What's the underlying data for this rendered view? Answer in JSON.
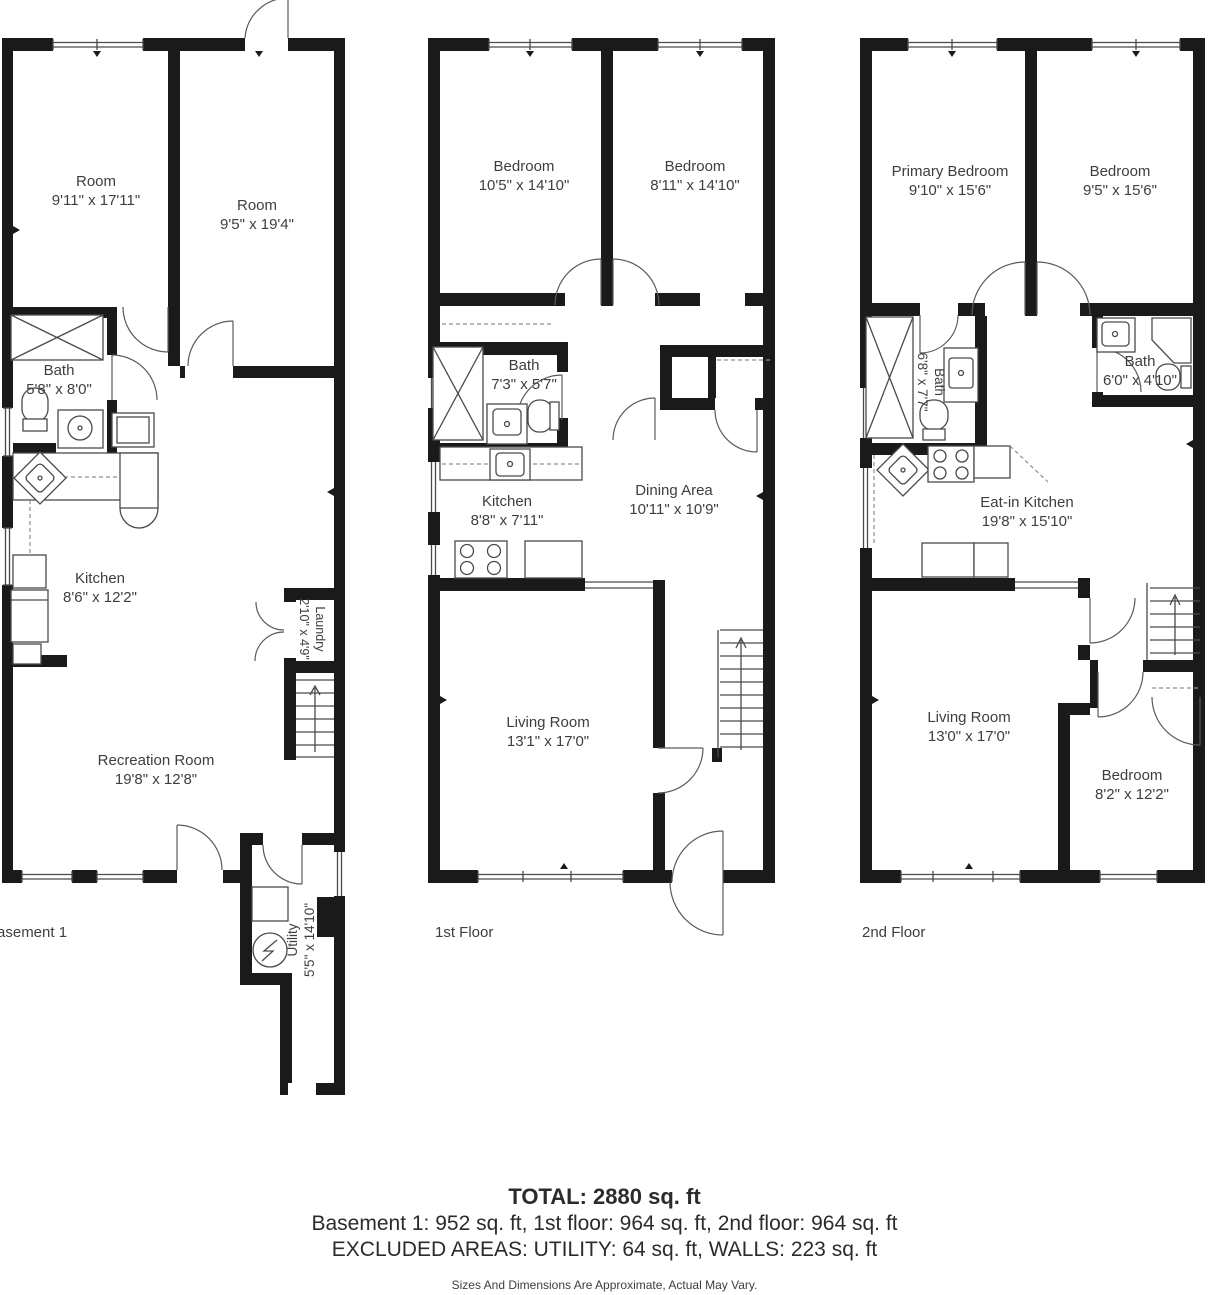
{
  "page": {
    "background": "#ffffff"
  },
  "colors": {
    "wall": "#1a1a1a",
    "thin_line": "#4a4a4a",
    "text": "#3e3e3e"
  },
  "floors": [
    {
      "id": "basement",
      "label": "Basement 1",
      "rooms": [
        {
          "name": "Room",
          "dims": "9'11\" x 17'11\""
        },
        {
          "name": "Room",
          "dims": "9'5\" x 19'4\""
        },
        {
          "name": "Bath",
          "dims": "5'8\" x 8'0\""
        },
        {
          "name": "Kitchen",
          "dims": "8'6\" x 12'2\""
        },
        {
          "name": "Laundry",
          "dims": "2'10\" x 4'9\""
        },
        {
          "name": "Recreation Room",
          "dims": "19'8\" x 12'8\""
        },
        {
          "name": "Utility",
          "dims": "5'5\" x 14'10\""
        }
      ],
      "fixtures": [
        "shower-icon",
        "toilet-icon",
        "sink-icon",
        "corner-sink-icon",
        "fridge-icon",
        "washer-icon",
        "stairs-up-icon",
        "double-door-icon",
        "electrical-panel-icon",
        "window-icon",
        "door-arc-icon"
      ]
    },
    {
      "id": "first-floor",
      "label": "1st Floor",
      "rooms": [
        {
          "name": "Bedroom",
          "dims": "10'5\" x 14'10\""
        },
        {
          "name": "Bedroom",
          "dims": "8'11\" x 14'10\""
        },
        {
          "name": "Bath",
          "dims": "7'3\" x 5'7\""
        },
        {
          "name": "Kitchen",
          "dims": "8'8\" x 7'11\""
        },
        {
          "name": "Dining Area",
          "dims": "10'11\" x 10'9\""
        },
        {
          "name": "Living Room",
          "dims": "13'1\" x 17'0\""
        }
      ],
      "fixtures": [
        "shower-icon",
        "toilet-icon",
        "sink-icon",
        "stove-icon",
        "stairs-up-icon",
        "closet-rod-icon",
        "window-icon",
        "door-arc-icon"
      ]
    },
    {
      "id": "second-floor",
      "label": "2nd Floor",
      "rooms": [
        {
          "name": "Primary Bedroom",
          "dims": "9'10\" x 15'6\""
        },
        {
          "name": "Bedroom",
          "dims": "9'5\" x 15'6\""
        },
        {
          "name": "Bath",
          "dims": "6'8\" x 7'7\""
        },
        {
          "name": "Bath",
          "dims": "6'0\" x 4'10\""
        },
        {
          "name": "Eat-in Kitchen",
          "dims": "19'8\" x 15'10\""
        },
        {
          "name": "Living Room",
          "dims": "13'0\" x 17'0\""
        },
        {
          "name": "Bedroom",
          "dims": "8'2\" x 12'2\""
        }
      ],
      "fixtures": [
        "shower-icon",
        "corner-shower-icon",
        "toilet-icon",
        "sink-icon",
        "corner-sink-icon",
        "stove-icon",
        "stairs-up-icon",
        "closet-rod-icon",
        "window-icon",
        "door-arc-icon"
      ]
    }
  ],
  "summary": {
    "total": "TOTAL: 2880 sq. ft",
    "line1": "Basement 1: 952 sq. ft, 1st floor: 964 sq. ft, 2nd floor: 964 sq. ft",
    "line2": "EXCLUDED AREAS: UTILITY: 64 sq. ft, WALLS: 223 sq. ft",
    "disclaimer": "Sizes And Dimensions Are Approximate, Actual May Vary."
  }
}
